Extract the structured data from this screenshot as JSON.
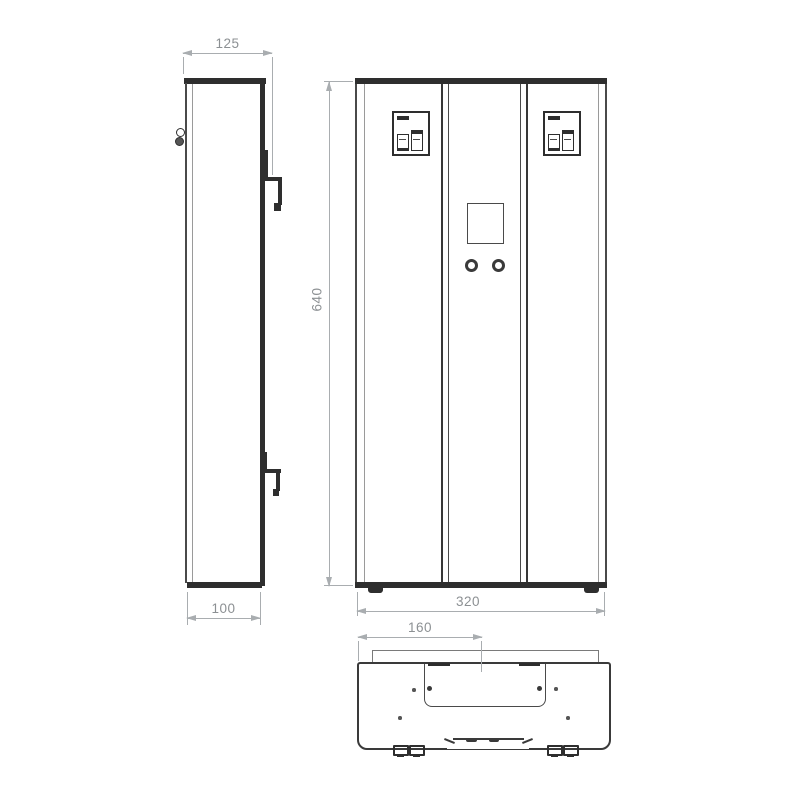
{
  "colors": {
    "line_dark": "#2e2e2e",
    "line_mid": "#4a4a4a",
    "line_light": "#9a9a9a",
    "dim_line": "#a9adb0",
    "dim_text": "#8c9093",
    "bg": "#ffffff"
  },
  "dimensions": {
    "depth_overall": {
      "value": "125"
    },
    "height": {
      "value": "640"
    },
    "depth_body": {
      "value": "100"
    },
    "width": {
      "value": "320"
    },
    "rail_offset": {
      "value": "160"
    }
  }
}
